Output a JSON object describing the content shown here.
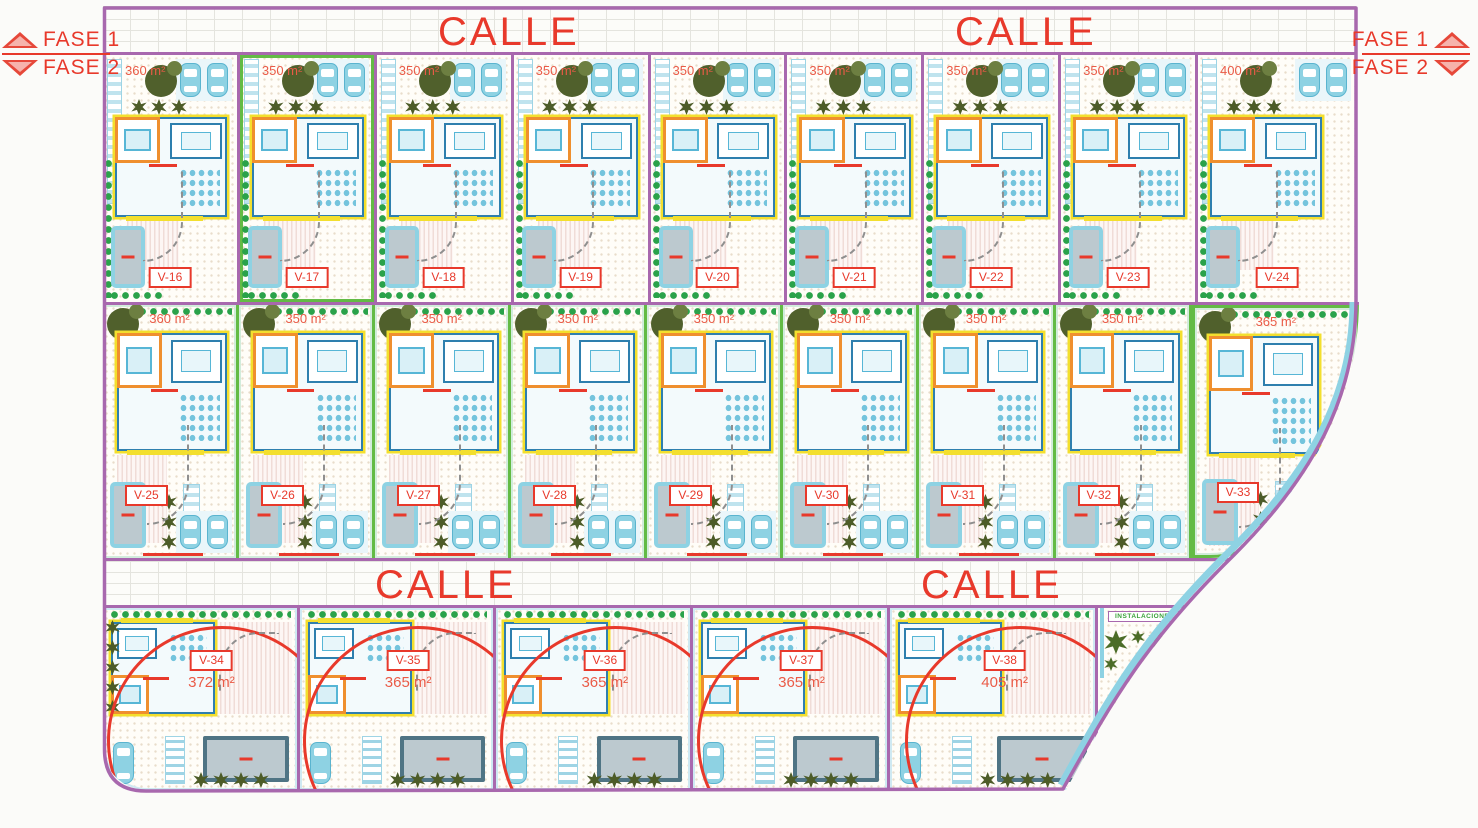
{
  "legend": {
    "fase1": "FASE 1",
    "fase2": "FASE 2"
  },
  "streets": {
    "top": [
      "CALLE",
      "CALLE"
    ],
    "middle": [
      "CALLE",
      "CALLE"
    ]
  },
  "corner": {
    "label": "INSTALACIONES"
  },
  "rows": {
    "top": [
      {
        "id": "V-16",
        "area": "360 m²"
      },
      {
        "id": "V-17",
        "area": "350 m²"
      },
      {
        "id": "V-18",
        "area": "350 m²"
      },
      {
        "id": "V-19",
        "area": "350 m²"
      },
      {
        "id": "V-20",
        "area": "350 m²"
      },
      {
        "id": "V-21",
        "area": "350 m²"
      },
      {
        "id": "V-22",
        "area": "350 m²"
      },
      {
        "id": "V-23",
        "area": "350 m²"
      },
      {
        "id": "V-24",
        "area": "400 m²"
      }
    ],
    "middle": [
      {
        "id": "V-25",
        "area": "360 m²"
      },
      {
        "id": "V-26",
        "area": "350 m²"
      },
      {
        "id": "V-27",
        "area": "350 m²"
      },
      {
        "id": "V-28",
        "area": "350 m²"
      },
      {
        "id": "V-29",
        "area": "350 m²"
      },
      {
        "id": "V-30",
        "area": "350 m²"
      },
      {
        "id": "V-31",
        "area": "350 m²"
      },
      {
        "id": "V-32",
        "area": "350 m²"
      },
      {
        "id": "V-33",
        "area": "365 m²"
      }
    ],
    "bottom": [
      {
        "id": "V-34",
        "area": "372 m²"
      },
      {
        "id": "V-35",
        "area": "365 m²"
      },
      {
        "id": "V-36",
        "area": "365 m²"
      },
      {
        "id": "V-37",
        "area": "365 m²"
      },
      {
        "id": "V-38",
        "area": "405 m²"
      }
    ]
  },
  "colors": {
    "boundary_purple": "#a868ae",
    "plot_green": "#63bb45",
    "label_red": "#e8392b",
    "sidewalk_cyan": "#8ed2e3",
    "wall_blue": "#2e7fae",
    "accent_yellow": "#f3df2e",
    "accent_orange": "#ef8f2e",
    "tree_olive": "#50602c",
    "hedge_green": "#2aa24a",
    "pool_water": "#bcc9cf"
  }
}
